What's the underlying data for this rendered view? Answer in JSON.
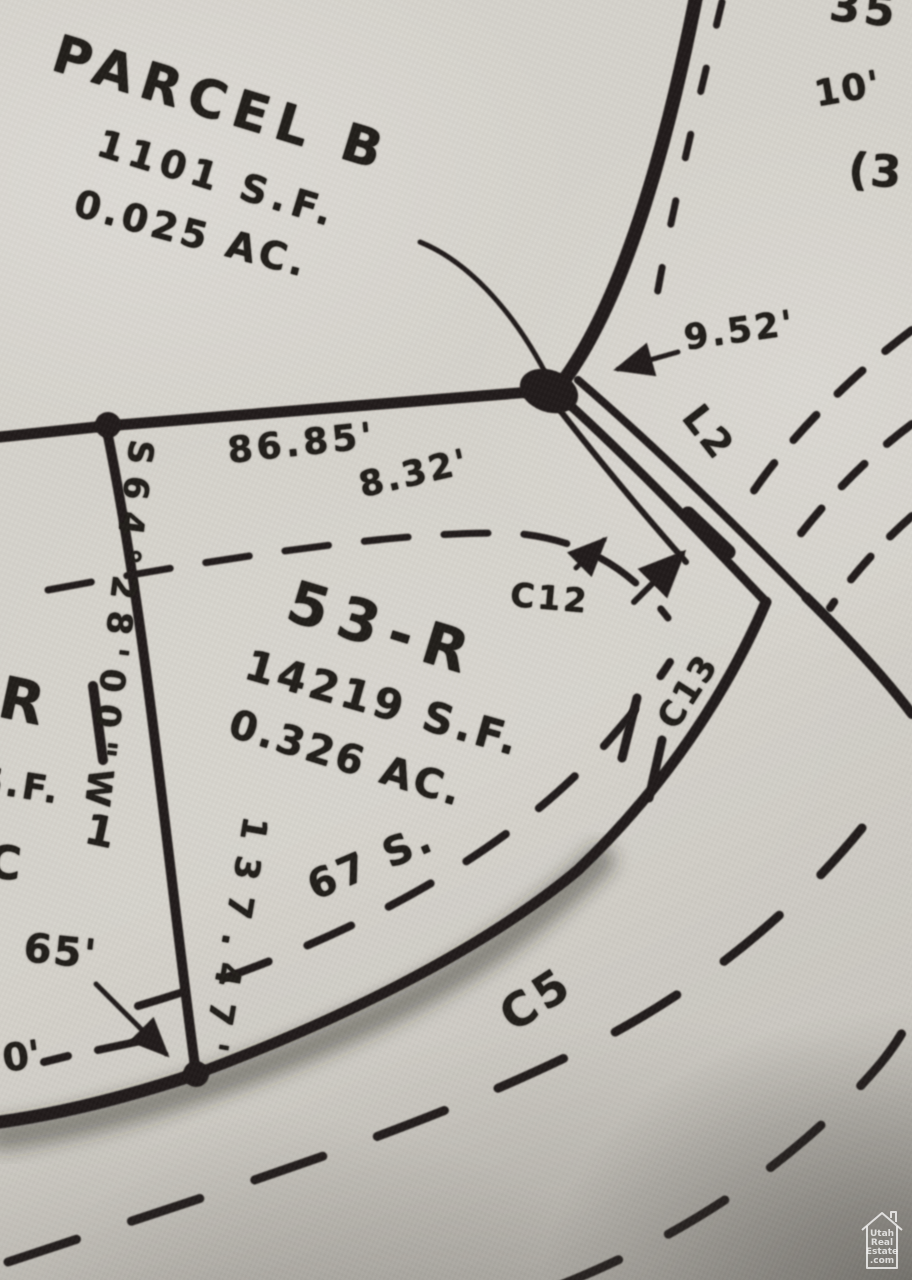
{
  "map": {
    "type": "plat-survey-photo",
    "photo": {
      "paper_color": "#d7d4cd",
      "ink_color": "#221f1b",
      "corner_shadow_color": "#302e2a"
    },
    "labels": {
      "parcel_b": {
        "name": "PARCEL B",
        "area_sf": "1101 S.F.",
        "area_ac": "0.025 AC."
      },
      "lot_53_r": {
        "name": "53-R",
        "area_sf": "14219 S.F.",
        "area_ac": "0.326 AC."
      },
      "dimensions": {
        "d952": "9.52'",
        "d8685": "86.85'",
        "d832": "8.32'",
        "d13747": "137.47'",
        "d65": "65'",
        "d10": "10'",
        "bearing": "S64°28'00\"W"
      },
      "curves": {
        "c12": "C12",
        "c13": "C13",
        "c5": "C5",
        "l2": "L2"
      },
      "partials": {
        "p35": "35",
        "paren3": "(3",
        "p67s": "67 S.",
        "r": "R",
        "sf": "S.F.",
        "one": "1",
        "c": "C",
        "zero": "0'"
      }
    },
    "watermark": {
      "l1": "Utah",
      "l2": "Real",
      "l3": "Estate",
      "l4": ".com"
    }
  }
}
